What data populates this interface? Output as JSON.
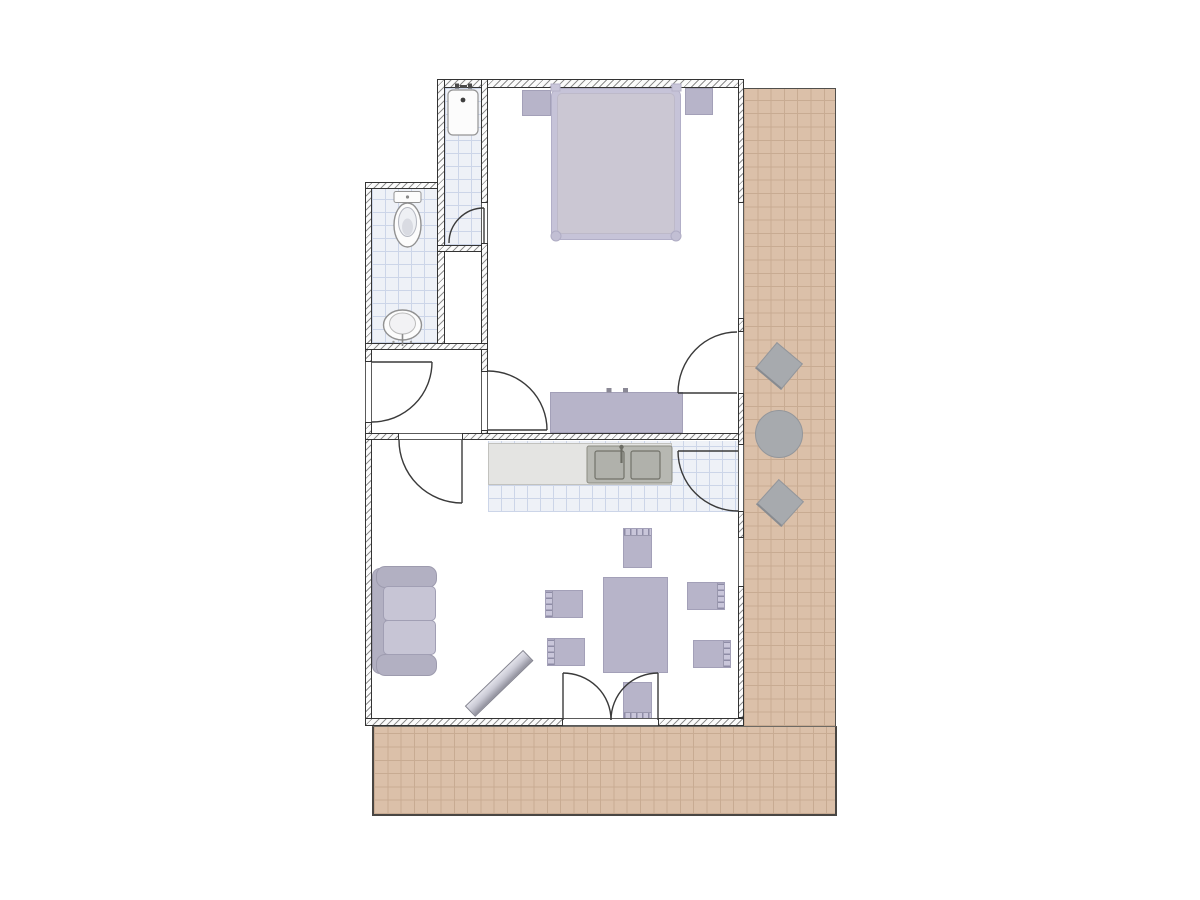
{
  "palette": {
    "background": "#ffffff",
    "wall_fill": "#fbfbfb",
    "wall_hatch": "#8f8f8f",
    "wall_edge": "#333333",
    "terrace_fill": "#dbc0a9",
    "terrace_grid": "#c8ab92",
    "tile_fill": "#eef1f7",
    "tile_grid": "#ccd5e8",
    "furniture_lavender": "#b7b4c9",
    "furniture_outline": "#a3a0b8",
    "bed_frame": "#c6c3d8",
    "bed_duvet": "#cbc7d3",
    "sofa_body": "#b2b0c2",
    "sofa_cushion": "#c7c5d5",
    "counter_fill": "#e4e4e2",
    "sink_fill": "#b7b8b2",
    "metal_gray": "#a7aaae",
    "door_stroke": "#3a3a3a",
    "fixture_fill": "#fcfcfc",
    "fixture_stroke": "#949494"
  },
  "floorplan": {
    "rooms": [
      "bedroom",
      "bathroom",
      "shower-room",
      "closet",
      "hallway",
      "kitchen",
      "living-room",
      "terrace-side",
      "terrace-bottom"
    ],
    "doors": [
      "entrance-door",
      "hall-living-door",
      "hall-bedroom-door",
      "shower-door",
      "bedroom-terrace-door",
      "kitchen-terrace-door",
      "french-double-door"
    ],
    "windows": [
      "bedroom-window",
      "living-room-window"
    ],
    "fixtures": [
      "shower-tray",
      "toilet",
      "bidet",
      "kitchen-sink",
      "kitchen-counter"
    ],
    "furniture": {
      "bedroom": [
        "double-bed",
        "nightstand-left",
        "nightstand-right",
        "dresser"
      ],
      "living_room": [
        "sofa",
        "tv-board",
        "dining-table",
        "dining-chairs"
      ],
      "terrace": [
        "round-table",
        "terrace-chairs"
      ]
    },
    "counts": {
      "dining_chairs": 6,
      "terrace_chairs": 2,
      "sink_basins": 2
    }
  }
}
